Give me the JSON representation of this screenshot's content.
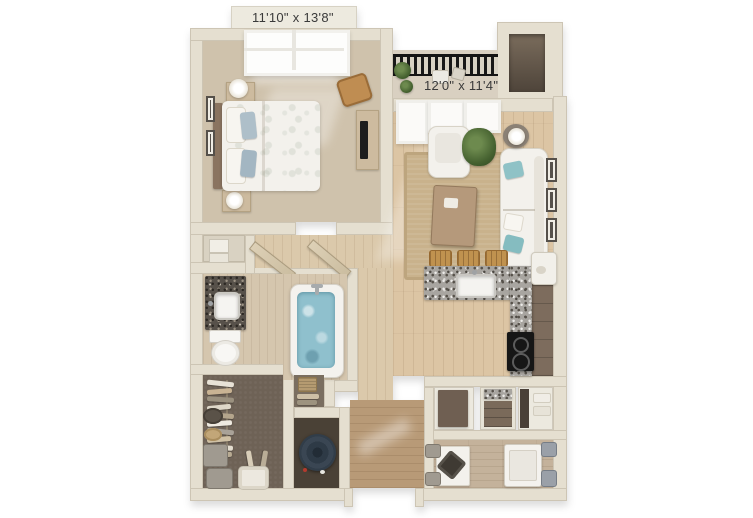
{
  "image": {
    "kind": "3d-floor-plan-rendering",
    "width_px": 753,
    "height_px": 518,
    "background": "#ffffff"
  },
  "labels": {
    "bedroom_dimensions": "11'10\" x 13'8\"",
    "living_dimensions": "12'0\" x 11'4\""
  },
  "palette": {
    "wall": "#e5dfd0",
    "bedroom_carpet": "#cfc2ac",
    "living_wood": "#dcc5a4",
    "hall_wood": "#dbc9ab",
    "entry_wood": "#b89a77",
    "laundry_wood": "#c4b29b",
    "closet_carpet": "#6e6256",
    "utility_floor": "#4a4136",
    "granite_counter": "#a8a5a0",
    "vanity_granite": "#57514a",
    "cabinet_brown": "#7d6c5d",
    "sofa_white": "#f3f1ec",
    "accent_teal": "#8fc2c6",
    "pillow_blue": "#aebfc9",
    "rug_jute": "#c9b28c",
    "railing_black": "#181818",
    "plant_green": "#44602f",
    "tub_water": "#8fc0cd",
    "water_heater": "#3a4653",
    "label_text": "#3a3a3a"
  },
  "furniture": {
    "bedroom": [
      "bed",
      "blue-pillows",
      "nightstands",
      "table-lamps",
      "dresser",
      "tv",
      "accent-chair",
      "wall-art",
      "window"
    ],
    "balcony": [
      "black-railing",
      "potted-plants",
      "bistro-set"
    ],
    "living_room": [
      "sofa",
      "teal-accent-pillows",
      "armchair",
      "coffee-table",
      "jute-rug",
      "floor-plant",
      "side-tables",
      "table-lamps",
      "gallery-frames",
      "windows"
    ],
    "kitchen": [
      "l-shaped-granite-peninsula",
      "sink",
      "bar-stools",
      "cooktop-range",
      "brown-cabinets",
      "refrigerator"
    ],
    "bathroom": [
      "granite-vanity",
      "vanity-sink",
      "toilet",
      "soaking-tub"
    ],
    "walk_in_closet": [
      "hanging-clothes",
      "closet-rod",
      "round-baskets",
      "hamper",
      "laundry-basket"
    ],
    "utility_closet": [
      "water-heater"
    ],
    "entry": [
      "front-door-opening",
      "entry-closet"
    ],
    "laundry_room": [
      "washer-dryer",
      "side-table",
      "storage-cubes",
      "storage-baskets"
    ]
  }
}
